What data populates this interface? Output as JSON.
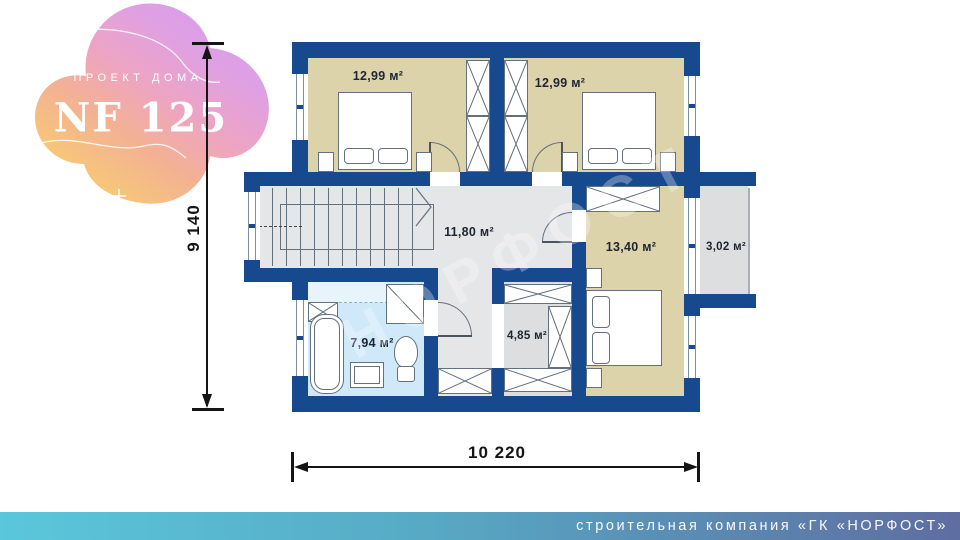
{
  "badge": {
    "kicker": "ПРОЕКТ ДОМА",
    "code": "NF 125"
  },
  "plan": {
    "rooms": [
      {
        "id": "bedroom-1",
        "area": "12,99 м²"
      },
      {
        "id": "bedroom-2",
        "area": "12,99 м²"
      },
      {
        "id": "hall",
        "area": "11,80 м²"
      },
      {
        "id": "bedroom-3",
        "area": "13,40 м²"
      },
      {
        "id": "balcony",
        "area": "3,02 м²"
      },
      {
        "id": "bathroom",
        "area": "7,94 м²"
      },
      {
        "id": "wardrobe",
        "area": "4,85 м²"
      }
    ],
    "dimensions": {
      "height": "9 140",
      "width": "10 220"
    },
    "watermark": "НОРФОСТ"
  },
  "footer": {
    "company_line": "строительная компания «ГК «НОРФОСТ»"
  },
  "colors": {
    "wall": "#17498f",
    "bedroom_floor": "#ddd3ab",
    "hall_floor": "#e5e6e8",
    "bathroom_floor": "#cfe9f8",
    "balcony_floor": "#dcdee0",
    "footer_gradient_start": "#5ac7db",
    "footer_gradient_end": "#5f6da1",
    "blob_yellow": "#f9d469",
    "blob_pink": "#eda4c4",
    "blob_purple": "#d69df2"
  }
}
